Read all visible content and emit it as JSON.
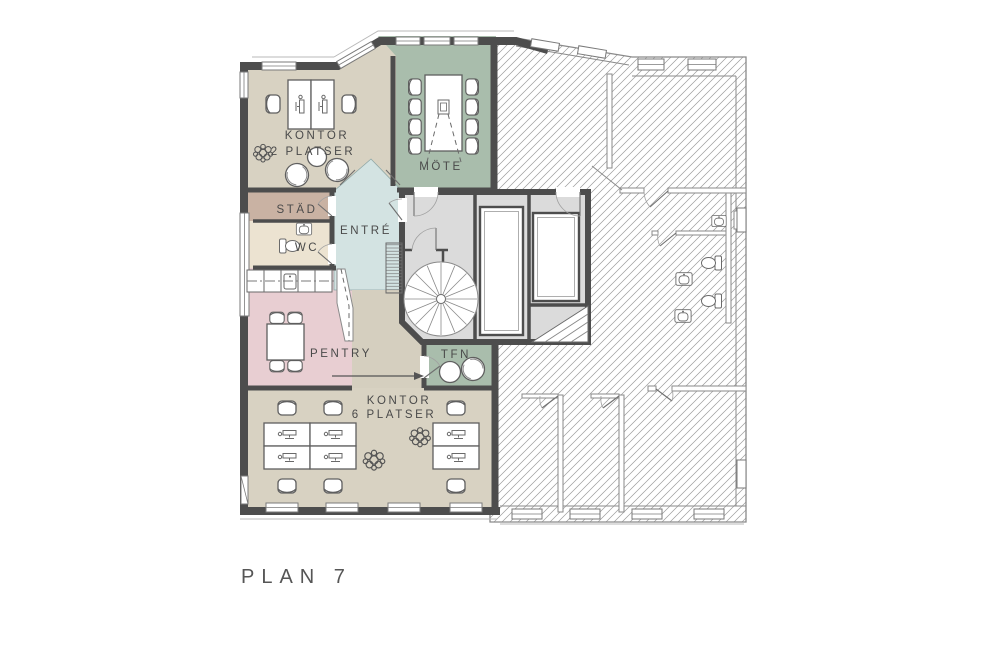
{
  "plan_label": "PLAN 7",
  "rooms": {
    "kontor2": {
      "line1": "KONTOR",
      "line2": "2 PLATSER",
      "color": "#d8d2c2"
    },
    "mote": {
      "label": "MÖTE",
      "color": "#a9bdac"
    },
    "stad": {
      "label": "STÄD",
      "color": "#c9b2a3"
    },
    "wc": {
      "label": "WC",
      "color": "#ece3d1"
    },
    "entre": {
      "label": "ENTRÉ",
      "color": "#d3e3e2"
    },
    "pentry": {
      "label": "PENTRY",
      "color": "#e8ced2"
    },
    "tfn": {
      "label": "TFN",
      "color": "#a9bdac"
    },
    "kontor6": {
      "line1": "KONTOR",
      "line2": "6 PLATSER",
      "color": "#d8d2c2"
    },
    "corridor": {
      "color": "#d5cfbf"
    },
    "core": {
      "color": "#dbdbdb"
    }
  },
  "palette": {
    "wall": "#4d4d4d",
    "thin_wall": "#8a8a8a",
    "hatch_line": "#9b9b9b",
    "label_text": "#4a4a4a",
    "background": "#ffffff"
  }
}
